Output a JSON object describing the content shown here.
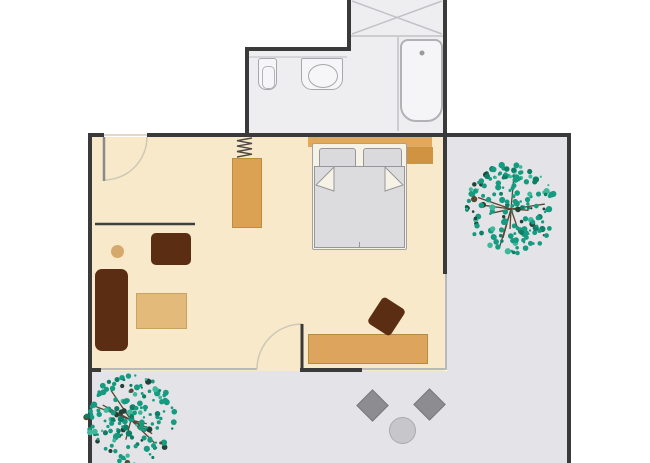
{
  "meta": {
    "type": "floor-plan",
    "description": "Apartment floor plan: bathroom with shower, bathtub, washbasin and toilet at top; studio room with double bed, wardrobe, radiator, sofa group, wall desk and terrace door; L-shaped terrace with two trees and a patio seating group"
  },
  "palette": {
    "background": "#ffffff",
    "wall": "#3a3a3a",
    "window_wall": "#b9b9bd",
    "room_floor": "#f8e9ca",
    "bathroom_floor": "#eeeef1",
    "terrace_floor": "#e4e4e8",
    "fixture_fill": "#f6f6f8",
    "fixture_line": "#a8a8ac",
    "tub_fill": "#f5f5f7",
    "faucet_dot": "#9a9a9e",
    "wood_wardrobe": "#dba253",
    "wood_desk": "#dca45c",
    "wood_table": "#e3ba79",
    "wood_shelf": "#e0a95e",
    "wood_nightstand": "#cf9342",
    "stool_tan": "#d4a96b",
    "brown_dark": "#5b2d12",
    "bed_frame_fill": "#f6f2e6",
    "bed_line": "#97979b",
    "pillow_fill": "#dadadc",
    "blanket_fill": "#dcdcde",
    "patio_chair": "#8c8c91",
    "patio_table": "#c7c7cb",
    "tree_green": "#159b7f",
    "tree_green_dark": "#0c7f66",
    "tree_green_light": "#3db89a",
    "tree_speck_dark": "#234136",
    "tree_branch": "#5a4630",
    "door_arc": "#cfc8b8",
    "door_leaf_light": "#8a8a8a",
    "radiator_line": "#4e4a44",
    "shelf_line": "#3f3f3f",
    "shower_line": "#c2c2c6",
    "counter_line": "#cdcdd1",
    "threshold": "#e2dac6"
  },
  "areas": {
    "bathroom": {
      "name": "bathroom",
      "fixtures": [
        "shower",
        "bathtub",
        "washbasin",
        "toilet"
      ]
    },
    "room": {
      "name": "studio-room",
      "furniture": [
        "entry-door",
        "radiator",
        "wardrobe",
        "wall-desk-shelf",
        "stool",
        "armchair",
        "sofa",
        "coffee-table",
        "double-bed",
        "pillow-left",
        "pillow-right",
        "blanket",
        "headboard-shelf",
        "nightstand",
        "desk",
        "desk-chair",
        "terrace-door"
      ]
    },
    "terrace": {
      "name": "terrace",
      "objects": [
        "tree-right",
        "tree-bottom-left",
        "patio-chair-left",
        "patio-chair-right",
        "patio-table"
      ]
    }
  },
  "trees": [
    {
      "name": "tree-terrace-right",
      "seed": 7
    },
    {
      "name": "tree-terrace-bottom-left",
      "seed": 13
    }
  ]
}
